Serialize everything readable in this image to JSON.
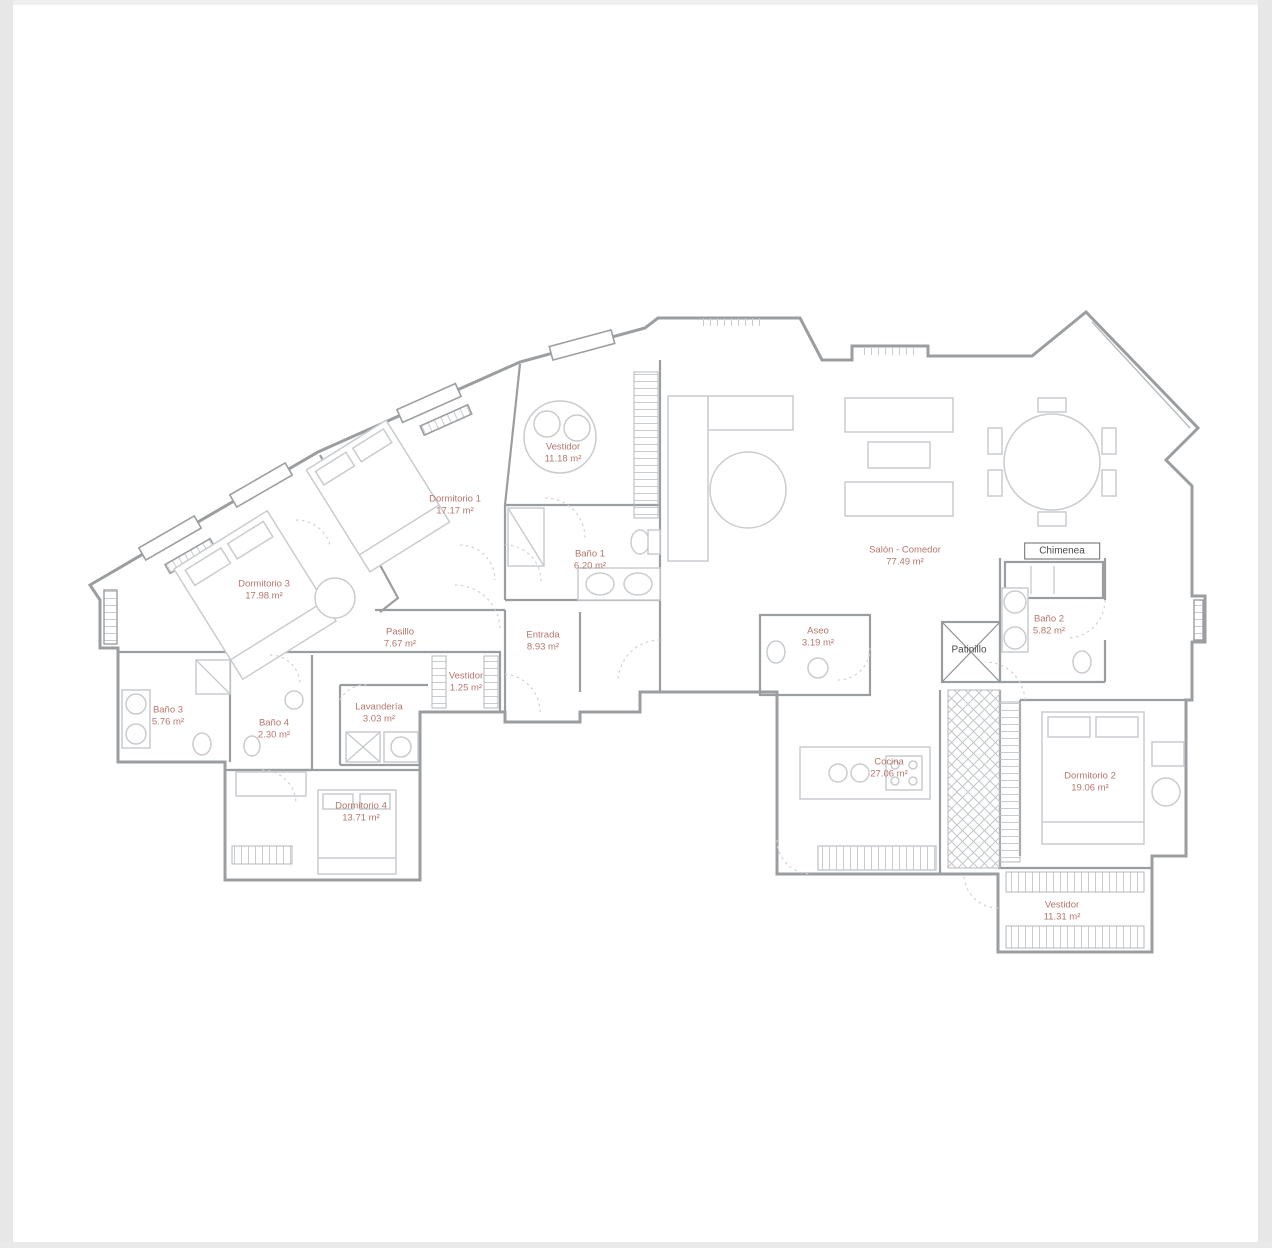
{
  "page": {
    "background_color": "#ffffff",
    "frame_color": "#e7e7e7",
    "label_color": "#b5766c",
    "wall_color": "#9b9ea0",
    "furniture_color": "#c9cccf"
  },
  "plan": {
    "type": "apartment-floor-plan",
    "rooms": [
      {
        "id": "vestidor-top",
        "name": "Vestidor",
        "area": "11.18 m²",
        "x": 563,
        "y": 453
      },
      {
        "id": "dormitorio-1",
        "name": "Dormitorio 1",
        "area": "17.17 m²",
        "x": 455,
        "y": 505
      },
      {
        "id": "dormitorio-3",
        "name": "Dormitorio 3",
        "area": "17.98 m²",
        "x": 264,
        "y": 590
      },
      {
        "id": "bano-1",
        "name": "Baño 1",
        "area": "6.20 m²",
        "x": 590,
        "y": 560
      },
      {
        "id": "salon-comedor",
        "name": "Salón - Comedor",
        "area": "77.49 m²",
        "x": 905,
        "y": 556
      },
      {
        "id": "bano-2",
        "name": "Baño 2",
        "area": "5.82 m²",
        "x": 1049,
        "y": 625
      },
      {
        "id": "pasillo",
        "name": "Pasillo",
        "area": "7.67 m²",
        "x": 400,
        "y": 638
      },
      {
        "id": "entrada",
        "name": "Entrada",
        "area": "8.93 m²",
        "x": 543,
        "y": 641
      },
      {
        "id": "vestidor-mid",
        "name": "Vestidor",
        "area": "1.25 m²",
        "x": 466,
        "y": 682
      },
      {
        "id": "aseo",
        "name": "Aseo",
        "area": "3.19 m²",
        "x": 818,
        "y": 637
      },
      {
        "id": "bano-3",
        "name": "Baño 3",
        "area": "5.76 m²",
        "x": 168,
        "y": 716
      },
      {
        "id": "bano-4",
        "name": "Baño 4",
        "area": "2.30 m²",
        "x": 274,
        "y": 729
      },
      {
        "id": "lavanderia",
        "name": "Lavandería",
        "area": "3.03 m²",
        "x": 379,
        "y": 713
      },
      {
        "id": "dormitorio-4",
        "name": "Dormitorio 4",
        "area": "13.71 m²",
        "x": 361,
        "y": 812
      },
      {
        "id": "cocina",
        "name": "Cocina",
        "area": "27.06 m²",
        "x": 889,
        "y": 768
      },
      {
        "id": "dormitorio-2",
        "name": "Dormitorio 2",
        "area": "19.06 m²",
        "x": 1090,
        "y": 782
      },
      {
        "id": "vestidor-bottom",
        "name": "Vestidor",
        "area": "11.31 m²",
        "x": 1062,
        "y": 911
      }
    ],
    "annotations": [
      {
        "id": "chimenea",
        "label": "Chimenea",
        "x": 1062,
        "y": 551
      },
      {
        "id": "patinillo",
        "label": "Patinillo",
        "x": 969,
        "y": 650
      }
    ]
  }
}
